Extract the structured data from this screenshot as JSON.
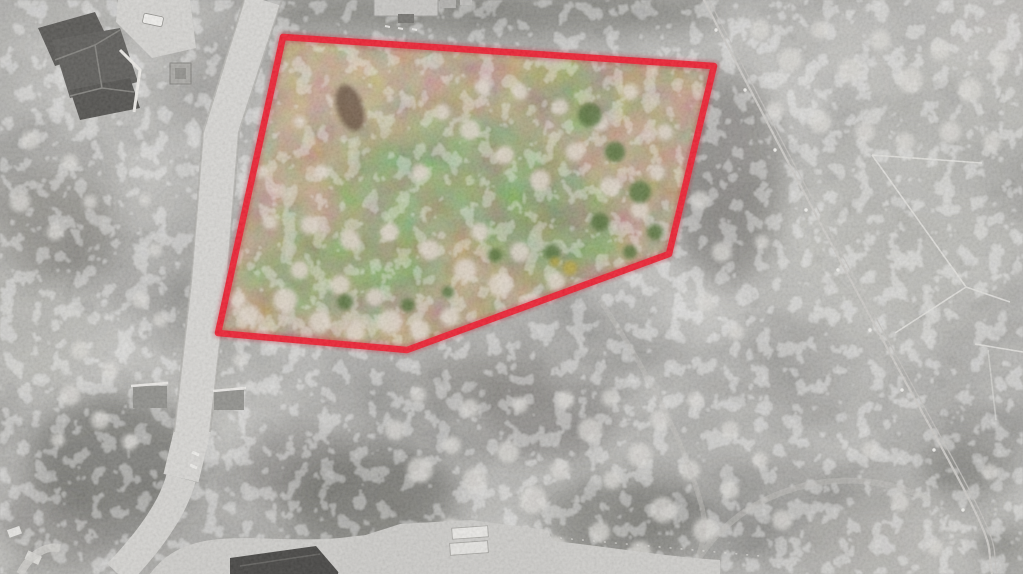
{
  "photo": {
    "boundary": {
      "points": "283,37 714,66 669,254 407,350 218,333",
      "color": "#ed1528",
      "glow_color": "#c40f22",
      "width": 6.5
    },
    "palette": {
      "surroundings_gray": "#96958f",
      "road": "#d6d5d2",
      "parcel_field_tan": "#b3986f",
      "parcel_grass_green": "#7f9c55",
      "tree_canopy_light": "#ddd3c7",
      "dark_foliage": "#4e6b33",
      "roof_dark": "#4f4e4b",
      "concrete": "#cbcac7"
    }
  }
}
